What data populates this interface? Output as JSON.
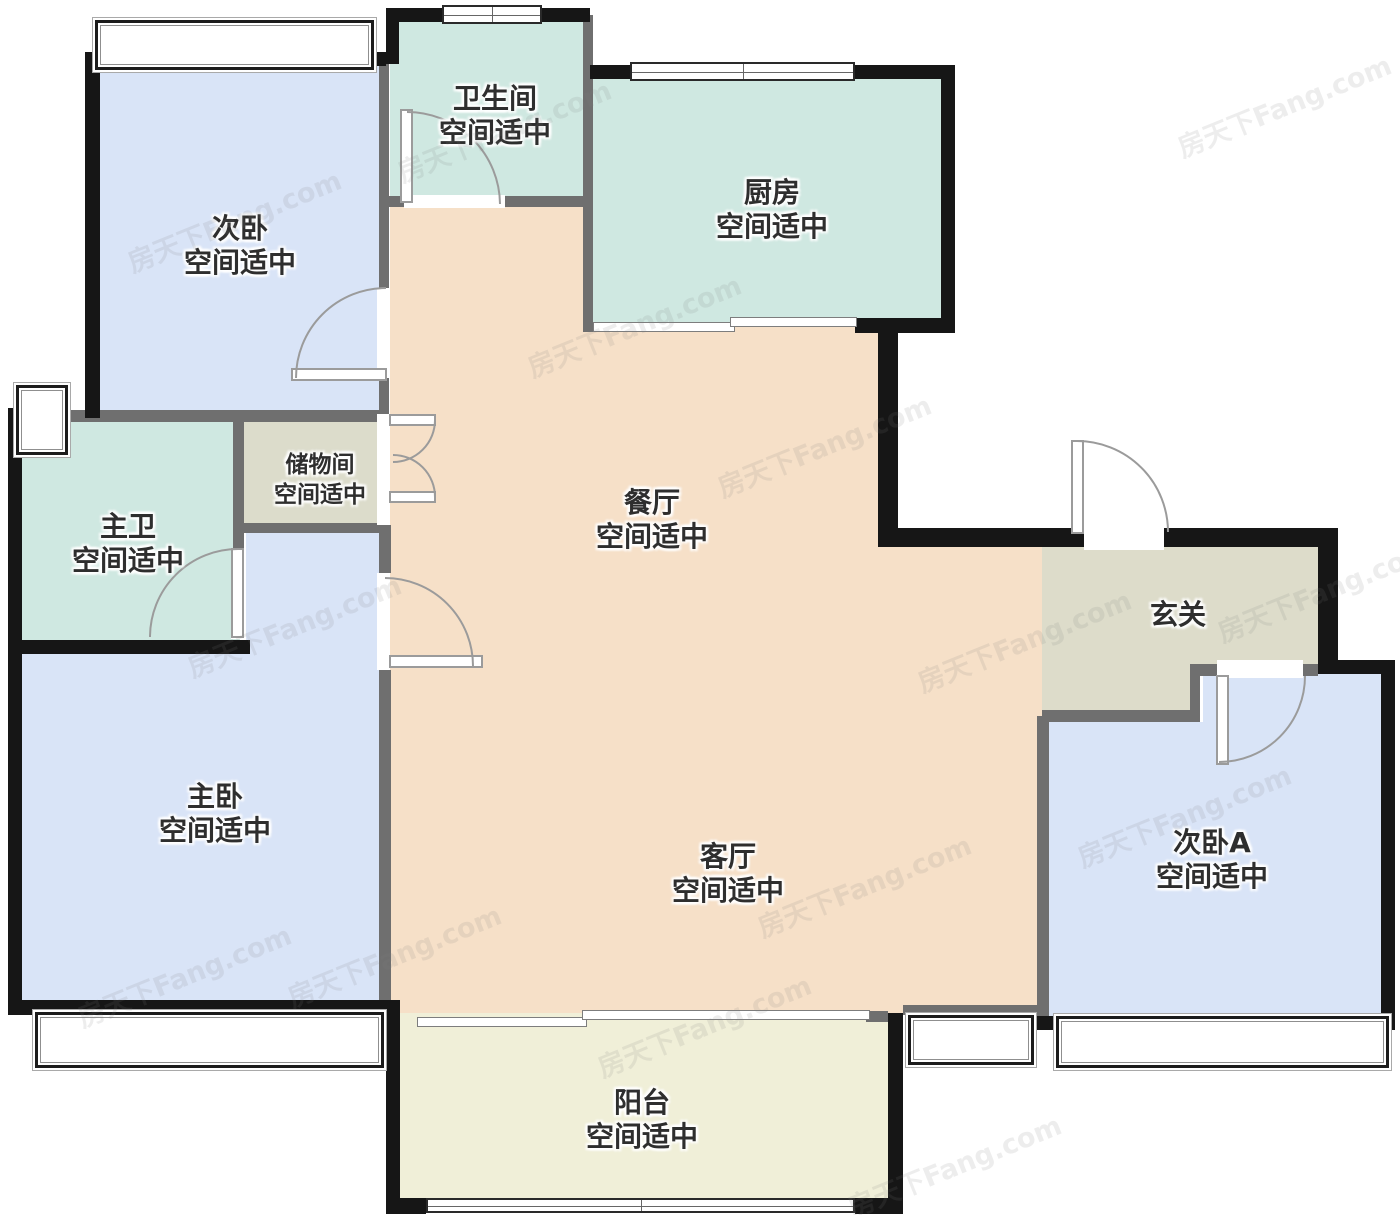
{
  "watermark": "房天下Fang.com",
  "colors": {
    "bedroom": "#d9e4f7",
    "bath": "#cfe8e1",
    "living": "#f6e0c8",
    "storage": "#dcdccb",
    "hall": "#dddcca",
    "balcony": "#f0efd8",
    "wall": "#161616",
    "partition": "#6f6f6f"
  },
  "rooms": {
    "ciwo": {
      "name": "次卧",
      "status": "空间适中"
    },
    "weishengjian": {
      "name": "卫生间",
      "status": "空间适中"
    },
    "chufang": {
      "name": "厨房",
      "status": "空间适中"
    },
    "zhuwei": {
      "name": "主卫",
      "status": "空间适中"
    },
    "chuwujian": {
      "name": "储物间",
      "status": "空间适中"
    },
    "canting": {
      "name": "餐厅",
      "status": "空间适中"
    },
    "xuanguan": {
      "name": "玄关"
    },
    "zhuwo": {
      "name": "主卧",
      "status": "空间适中"
    },
    "keting": {
      "name": "客厅",
      "status": "空间适中"
    },
    "ciwo_a": {
      "name": "次卧A",
      "status": "空间适中"
    },
    "yangtai": {
      "name": "阳台",
      "status": "空间适中"
    }
  }
}
